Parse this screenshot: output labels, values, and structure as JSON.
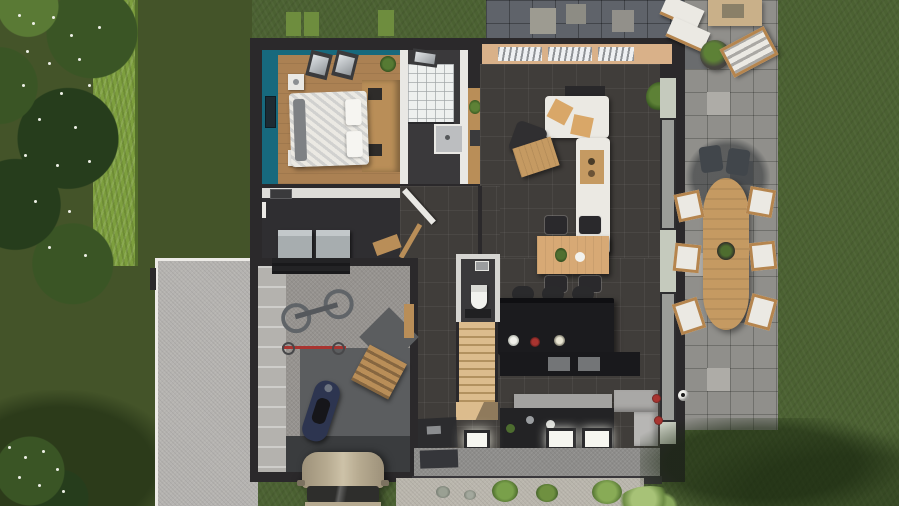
{
  "scene": {
    "type": "3d-architectural-floorplan-top-view",
    "description": "Top-down 3D render of a house ground floor with garden, hedge, driveway, paved patio and lawn",
    "visible_text": "none"
  },
  "palette": {
    "grass": "#4b6132",
    "grassLeft": "#445429",
    "treeDark": "#263d1c",
    "treeMid": "#3a5525",
    "treeLight": "#5a7a35",
    "blossom": "#edf0e6",
    "hedge": "#7d9f3e",
    "hedgeDark": "#54702a",
    "driveway": "#b5b3b0",
    "edgeWhite": "#eceae6",
    "paverTop": "#5f636a",
    "paverTopLight": "#9d9b91",
    "paver": "#908f8b",
    "paverLight": "#aeaca7",
    "paverDark": "#6a6c6e",
    "wall": "#2b292b",
    "teal": "#17697d",
    "wood": "#ab8153",
    "woodMid": "#b98e58",
    "woodLight": "#dcbc8d",
    "woodTable": "#d7a975",
    "white": "#e9e8e4",
    "glow": "#f6f6f0",
    "charcoal": "#403d3a",
    "tan": "#d9b189",
    "kdark": "#1b1b1e",
    "counter": "#a3a2a0",
    "bench": "#b2b1af",
    "sofa": "#ebe9e3",
    "cushion": "#d9a768",
    "chair": "#2a292c",
    "owood": "#c59a62",
    "gfloor": "#96938f",
    "gdark": "#5b5d5f",
    "mat": "#3a3c3e",
    "appl": "#a7adaf",
    "car": "#b6aa90",
    "gravel": "#bab6ad",
    "bush": "#6f9040",
    "red": "#a83430",
    "moto": "#2d3550",
    "bath": "#3a393b",
    "wwall": "#dddcd8",
    "glass": "#9b9d99",
    "pane": "#c5cabd"
  },
  "rooms": [
    {
      "id": "bedroom",
      "name": "Bedroom",
      "wall_color": "#17697d",
      "floor": "wood",
      "furniture": [
        "double-bed",
        "headboard-wardrobe",
        "nightstands",
        "skylights",
        "wall-frame",
        "plant"
      ]
    },
    {
      "id": "bathroom",
      "name": "Bathroom",
      "furniture": [
        "walk-in-shower",
        "shower-tray",
        "skylight",
        "white-partition"
      ]
    },
    {
      "id": "utility-room",
      "name": "Utility room",
      "furniture": [
        "washing-machine",
        "dryer",
        "window"
      ]
    },
    {
      "id": "hallway",
      "name": "Hallway",
      "furniture": [
        "open-door",
        "handrail"
      ]
    },
    {
      "id": "wc",
      "name": "WC",
      "furniture": [
        "toilet",
        "dark-mat",
        "wall-mirror"
      ]
    },
    {
      "id": "staircase",
      "name": "Staircase",
      "furniture": [
        "wooden-steps",
        "landing"
      ]
    },
    {
      "id": "living-room",
      "name": "Living room",
      "floor": "dark tile",
      "furniture": [
        "corner-sofa",
        "tan-cushions",
        "coffee-table",
        "armchair",
        "sideboard",
        "corner-plant",
        "window-wall"
      ]
    },
    {
      "id": "dining-area",
      "name": "Dining area",
      "furniture": [
        "wood-dining-table",
        "four-chairs"
      ]
    },
    {
      "id": "kitchen",
      "name": "Kitchen",
      "furniture": [
        "island-with-stools",
        "flower-vases",
        "tall-units",
        "counter",
        "lit-worktops",
        "corner-bench",
        "red-flowers"
      ]
    },
    {
      "id": "garage",
      "name": "Garage",
      "furniture": [
        "bike-rack",
        "mountain-bike",
        "red-bike",
        "motorcycle",
        "wood-workbench",
        "floor-mats"
      ]
    }
  ],
  "exterior": [
    {
      "id": "front-garden",
      "name": "Trees with white blossom and hedge"
    },
    {
      "id": "driveway",
      "name": "Concrete driveway"
    },
    {
      "id": "patio-top",
      "name": "Dark paver terrace"
    },
    {
      "id": "patio-right",
      "name": "Gray paver patio"
    },
    {
      "id": "outdoor-dining",
      "name": "Outdoor dining set",
      "items": [
        "oval-wood-table",
        "six-chairs",
        "parasol-shadow",
        "table-plant"
      ]
    },
    {
      "id": "lounge-corner",
      "name": "Lounge corner",
      "items": [
        "cushion-bench",
        "lounge-chair",
        "fire-table",
        "planter"
      ]
    },
    {
      "id": "lawn",
      "name": "Lawn",
      "items": [
        "soccer-ball",
        "tree-shadows",
        "flowering-shrubs"
      ]
    },
    {
      "id": "gravel-bed",
      "name": "Gravel planting bed"
    },
    {
      "id": "car",
      "name": "Parked car at garage door"
    }
  ]
}
